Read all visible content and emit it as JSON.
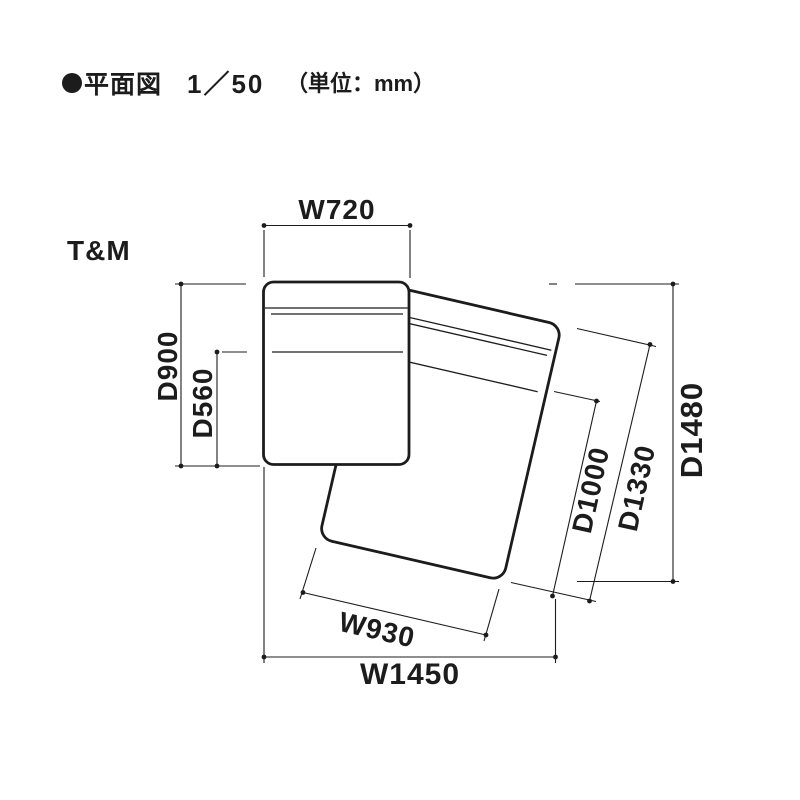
{
  "page": {
    "background": "#ffffff",
    "ink_color": "#1c1c1c"
  },
  "header": {
    "bullet_icon": "filled-circle",
    "title": "平面図",
    "scale": "1／50",
    "unit_note": "（単位：mm）"
  },
  "plan": {
    "model_label": "T&M",
    "dims": {
      "chair_width": "W720",
      "chair_depth": "D900",
      "seat_depth": "D560",
      "overall_width": "W1450",
      "ottoman_width": "W930",
      "overall_depth": "D1480",
      "ottoman_inner_depth": "D1000",
      "ottoman_outer_depth": "D1330"
    }
  }
}
